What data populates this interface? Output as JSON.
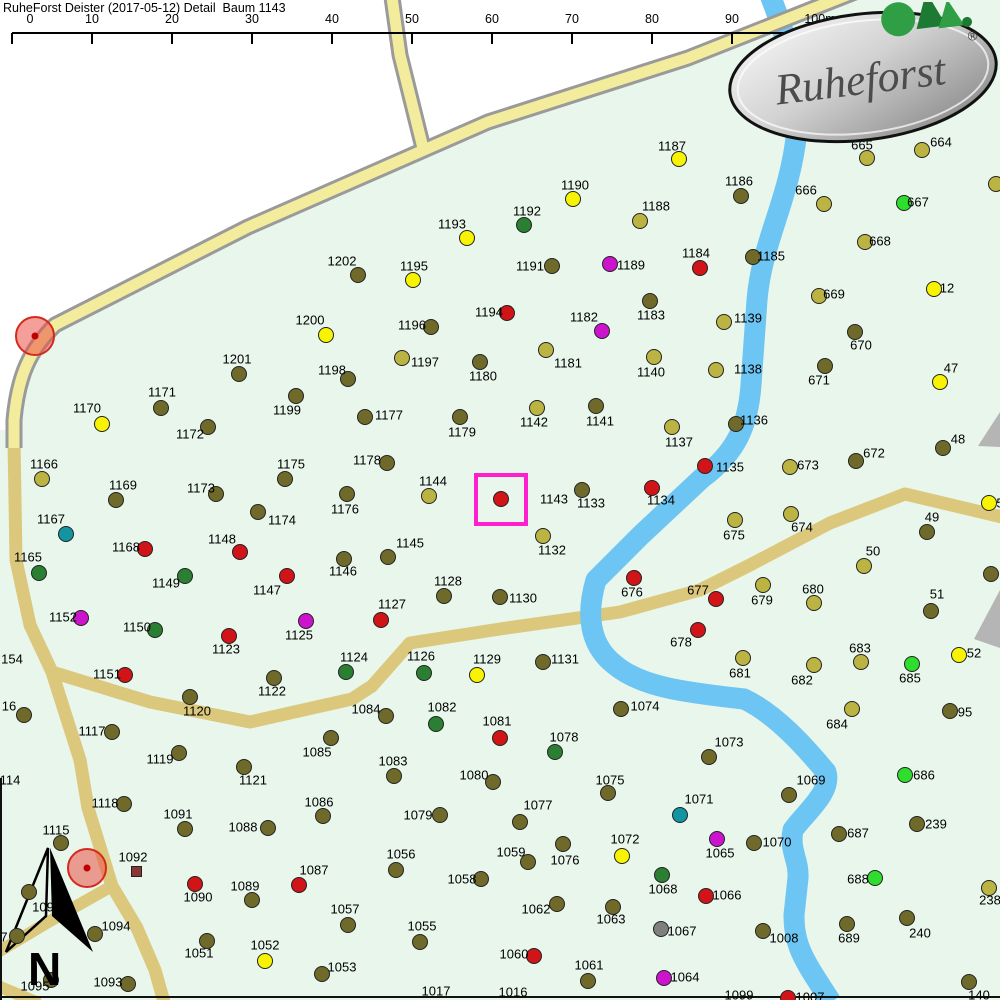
{
  "title": "RuheForst Deister (2017-05-12) Detail  Baum 1143",
  "scale_bar": {
    "y": 33,
    "x0": 12,
    "spacing": 80,
    "labels": [
      "0",
      "10",
      "20",
      "30",
      "40",
      "50",
      "60",
      "70",
      "80",
      "90",
      "100m"
    ]
  },
  "logo": {
    "text": "Ruheforst",
    "registered": "®"
  },
  "north_label": "N",
  "colors": {
    "o": "#6f6a2a",
    "k": "#bcb442",
    "y": "#f7f303",
    "g": "#2fdd2f",
    "dg": "#2b7f33",
    "r": "#d01418",
    "m": "#cc14cc",
    "t": "#1295a0",
    "gy": "#7f7f7f",
    "sq": "#8b3535"
  },
  "highlight": {
    "tree": "1143",
    "x": 474,
    "y": 473,
    "w": 54,
    "h": 53,
    "color": "#ff1fce"
  },
  "poi": [
    {
      "x": 35,
      "y": 336
    },
    {
      "x": 87,
      "y": 868
    }
  ],
  "trees": [
    {
      "n": "1187",
      "x": 679,
      "y": 159,
      "lx": 672,
      "ly": 146,
      "c": "y"
    },
    {
      "n": "1190",
      "x": 573,
      "y": 199,
      "lx": 575,
      "ly": 185,
      "c": "y"
    },
    {
      "n": "1192",
      "x": 524,
      "y": 225,
      "lx": 527,
      "ly": 211,
      "c": "dg"
    },
    {
      "n": "1188",
      "x": 640,
      "y": 221,
      "lx": 656,
      "ly": 206,
      "c": "k"
    },
    {
      "n": "1186",
      "x": 741,
      "y": 196,
      "lx": 739,
      "ly": 181,
      "c": "o"
    },
    {
      "n": "1193",
      "x": 467,
      "y": 238,
      "lx": 452,
      "ly": 224,
      "c": "y"
    },
    {
      "n": "1202",
      "x": 358,
      "y": 275,
      "lx": 342,
      "ly": 261,
      "c": "o"
    },
    {
      "n": "1195",
      "x": 413,
      "y": 280,
      "lx": 414,
      "ly": 266,
      "c": "y"
    },
    {
      "n": "1191",
      "x": 552,
      "y": 266,
      "lx": 530,
      "ly": 266,
      "c": "o"
    },
    {
      "n": "1189",
      "x": 610,
      "y": 264,
      "lx": 631,
      "ly": 265,
      "c": "m"
    },
    {
      "n": "1184",
      "x": 700,
      "y": 268,
      "lx": 696,
      "ly": 253,
      "c": "r"
    },
    {
      "n": "1185",
      "x": 753,
      "y": 257,
      "lx": 771,
      "ly": 256,
      "c": "o"
    },
    {
      "n": "1183",
      "x": 650,
      "y": 301,
      "lx": 651,
      "ly": 315,
      "c": "o"
    },
    {
      "n": "1194",
      "x": 507,
      "y": 313,
      "lx": 489,
      "ly": 312,
      "c": "r"
    },
    {
      "n": "1182",
      "x": 602,
      "y": 331,
      "lx": 584,
      "ly": 317,
      "c": "m"
    },
    {
      "n": "1181",
      "x": 546,
      "y": 350,
      "lx": 568,
      "ly": 363,
      "c": "k"
    },
    {
      "n": "1140",
      "x": 654,
      "y": 357,
      "lx": 651,
      "ly": 372,
      "c": "k"
    },
    {
      "n": "1139",
      "x": 724,
      "y": 322,
      "lx": 748,
      "ly": 318,
      "c": "k"
    },
    {
      "n": "1138",
      "x": 716,
      "y": 370,
      "lx": 748,
      "ly": 369,
      "c": "k"
    },
    {
      "n": "1136",
      "x": 736,
      "y": 424,
      "lx": 754,
      "ly": 420,
      "c": "o"
    },
    {
      "n": "1137",
      "x": 672,
      "y": 427,
      "lx": 679,
      "ly": 442,
      "c": "k"
    },
    {
      "n": "1135",
      "x": 705,
      "y": 466,
      "lx": 730,
      "ly": 467,
      "c": "r"
    },
    {
      "n": "1134",
      "x": 652,
      "y": 488,
      "lx": 661,
      "ly": 500,
      "c": "r"
    },
    {
      "n": "1133",
      "x": 582,
      "y": 490,
      "lx": 591,
      "ly": 503,
      "c": "o"
    },
    {
      "n": "1132",
      "x": 543,
      "y": 536,
      "lx": 552,
      "ly": 550,
      "c": "k"
    },
    {
      "n": "1143",
      "x": 501,
      "y": 499,
      "lx": 554,
      "ly": 499,
      "c": "r"
    },
    {
      "n": "1144",
      "x": 429,
      "y": 496,
      "lx": 433,
      "ly": 481,
      "c": "k"
    },
    {
      "n": "1145",
      "x": 388,
      "y": 557,
      "lx": 410,
      "ly": 543,
      "c": "o"
    },
    {
      "n": "1142",
      "x": 537,
      "y": 408,
      "lx": 534,
      "ly": 422,
      "c": "k"
    },
    {
      "n": "1141",
      "x": 596,
      "y": 406,
      "lx": 600,
      "ly": 421,
      "c": "o"
    },
    {
      "n": "1179",
      "x": 460,
      "y": 417,
      "lx": 462,
      "ly": 432,
      "c": "o"
    },
    {
      "n": "1180",
      "x": 480,
      "y": 362,
      "lx": 483,
      "ly": 376,
      "c": "o"
    },
    {
      "n": "1196",
      "x": 431,
      "y": 327,
      "lx": 412,
      "ly": 325,
      "c": "o"
    },
    {
      "n": "1197",
      "x": 402,
      "y": 358,
      "lx": 425,
      "ly": 362,
      "c": "k"
    },
    {
      "n": "1198",
      "x": 348,
      "y": 379,
      "lx": 332,
      "ly": 370,
      "c": "o"
    },
    {
      "n": "1200",
      "x": 326,
      "y": 335,
      "lx": 310,
      "ly": 320,
      "c": "y"
    },
    {
      "n": "1201",
      "x": 239,
      "y": 374,
      "lx": 237,
      "ly": 359,
      "c": "o"
    },
    {
      "n": "1199",
      "x": 296,
      "y": 396,
      "lx": 287,
      "ly": 410,
      "c": "o"
    },
    {
      "n": "1177",
      "x": 365,
      "y": 417,
      "lx": 389,
      "ly": 415,
      "c": "o"
    },
    {
      "n": "1178",
      "x": 387,
      "y": 463,
      "lx": 367,
      "ly": 460,
      "c": "o"
    },
    {
      "n": "1175",
      "x": 285,
      "y": 479,
      "lx": 291,
      "ly": 464,
      "c": "o"
    },
    {
      "n": "1176",
      "x": 347,
      "y": 494,
      "lx": 345,
      "ly": 509,
      "c": "o"
    },
    {
      "n": "1174",
      "x": 258,
      "y": 512,
      "lx": 282,
      "ly": 520,
      "c": "o"
    },
    {
      "n": "1171",
      "x": 161,
      "y": 408,
      "lx": 162,
      "ly": 392,
      "c": "o"
    },
    {
      "n": "1170",
      "x": 102,
      "y": 424,
      "lx": 87,
      "ly": 408,
      "c": "y"
    },
    {
      "n": "1172",
      "x": 208,
      "y": 427,
      "lx": 190,
      "ly": 434,
      "c": "o"
    },
    {
      "n": "1166",
      "x": 42,
      "y": 479,
      "lx": 44,
      "ly": 464,
      "c": "k"
    },
    {
      "n": "1169",
      "x": 116,
      "y": 500,
      "lx": 123,
      "ly": 485,
      "c": "o"
    },
    {
      "n": "1173",
      "x": 216,
      "y": 494,
      "lx": 201,
      "ly": 488,
      "c": "o"
    },
    {
      "n": "1167",
      "x": 66,
      "y": 534,
      "lx": 51,
      "ly": 519,
      "c": "t"
    },
    {
      "n": "1168",
      "x": 145,
      "y": 549,
      "lx": 126,
      "ly": 547,
      "c": "r"
    },
    {
      "n": "1148",
      "x": 240,
      "y": 552,
      "lx": 222,
      "ly": 539,
      "c": "r"
    },
    {
      "n": "1165",
      "x": 39,
      "y": 573,
      "lx": 28,
      "ly": 557,
      "c": "dg"
    },
    {
      "n": "1149",
      "x": 185,
      "y": 576,
      "lx": 166,
      "ly": 583,
      "c": "dg"
    },
    {
      "n": "1152",
      "x": 81,
      "y": 618,
      "lx": 63,
      "ly": 617,
      "c": "m"
    },
    {
      "n": "1150",
      "x": 155,
      "y": 630,
      "lx": 137,
      "ly": 627,
      "c": "dg"
    },
    {
      "n": "1123",
      "x": 229,
      "y": 636,
      "lx": 226,
      "ly": 649,
      "c": "r"
    },
    {
      "n": "1151",
      "x": 125,
      "y": 675,
      "lx": 107,
      "ly": 674,
      "c": "r"
    },
    {
      "n": "1120",
      "x": 190,
      "y": 697,
      "lx": 197,
      "ly": 711,
      "c": "o"
    },
    {
      "n": "1117",
      "x": 112,
      "y": 732,
      "lx": 92,
      "ly": 731,
      "c": "o"
    },
    {
      "n": "1119",
      "x": 179,
      "y": 753,
      "lx": 160,
      "ly": 759,
      "c": "o"
    },
    {
      "n": "1118",
      "x": 124,
      "y": 804,
      "lx": 105,
      "ly": 803,
      "c": "o"
    },
    {
      "n": "1121",
      "x": 244,
      "y": 767,
      "lx": 253,
      "ly": 780,
      "c": "o"
    },
    {
      "n": "1147",
      "x": 287,
      "y": 576,
      "lx": 267,
      "ly": 590,
      "c": "r"
    },
    {
      "n": "1146",
      "x": 344,
      "y": 559,
      "lx": 343,
      "ly": 571,
      "c": "o"
    },
    {
      "n": "1128",
      "x": 444,
      "y": 596,
      "lx": 448,
      "ly": 581,
      "c": "o"
    },
    {
      "n": "1127",
      "x": 381,
      "y": 620,
      "lx": 392,
      "ly": 604,
      "c": "r"
    },
    {
      "n": "1125",
      "x": 306,
      "y": 621,
      "lx": 299,
      "ly": 635,
      "c": "m"
    },
    {
      "n": "1124",
      "x": 346,
      "y": 672,
      "lx": 354,
      "ly": 657,
      "c": "dg"
    },
    {
      "n": "1126",
      "x": 424,
      "y": 673,
      "lx": 421,
      "ly": 656,
      "c": "dg"
    },
    {
      "n": "1129",
      "x": 477,
      "y": 675,
      "lx": 487,
      "ly": 659,
      "c": "y"
    },
    {
      "n": "1122",
      "x": 274,
      "y": 678,
      "lx": 272,
      "ly": 691,
      "c": "o"
    },
    {
      "n": "1130",
      "x": 500,
      "y": 597,
      "lx": 523,
      "ly": 598,
      "c": "o"
    },
    {
      "n": "1131",
      "x": 543,
      "y": 662,
      "lx": 565,
      "ly": 659,
      "c": "o"
    },
    {
      "n": "1084",
      "x": 386,
      "y": 716,
      "lx": 366,
      "ly": 709,
      "c": "o"
    },
    {
      "n": "1082",
      "x": 436,
      "y": 724,
      "lx": 442,
      "ly": 707,
      "c": "dg"
    },
    {
      "n": "1081",
      "x": 500,
      "y": 738,
      "lx": 497,
      "ly": 721,
      "c": "r"
    },
    {
      "n": "1085",
      "x": 331,
      "y": 738,
      "lx": 317,
      "ly": 752,
      "c": "o"
    },
    {
      "n": "1083",
      "x": 394,
      "y": 776,
      "lx": 393,
      "ly": 761,
      "c": "o"
    },
    {
      "n": "1080",
      "x": 493,
      "y": 782,
      "lx": 474,
      "ly": 775,
      "c": "o"
    },
    {
      "n": "1086",
      "x": 323,
      "y": 816,
      "lx": 319,
      "ly": 802,
      "c": "o"
    },
    {
      "n": "1074",
      "x": 621,
      "y": 709,
      "lx": 645,
      "ly": 706,
      "c": "o"
    },
    {
      "n": "1078",
      "x": 555,
      "y": 752,
      "lx": 564,
      "ly": 737,
      "c": "dg"
    },
    {
      "n": "1073",
      "x": 709,
      "y": 757,
      "lx": 729,
      "ly": 742,
      "c": "o"
    },
    {
      "n": "1075",
      "x": 608,
      "y": 793,
      "lx": 610,
      "ly": 780,
      "c": "o"
    },
    {
      "n": "1077",
      "x": 520,
      "y": 822,
      "lx": 538,
      "ly": 805,
      "c": "o"
    },
    {
      "n": "1071",
      "x": 680,
      "y": 815,
      "lx": 699,
      "ly": 799,
      "c": "t"
    },
    {
      "n": "676",
      "x": 634,
      "y": 578,
      "lx": 632,
      "ly": 592,
      "c": "r"
    },
    {
      "n": "677",
      "x": 716,
      "y": 599,
      "lx": 698,
      "ly": 590,
      "c": "r"
    },
    {
      "n": "678",
      "x": 698,
      "y": 630,
      "lx": 681,
      "ly": 642,
      "c": "r"
    },
    {
      "n": "675",
      "x": 735,
      "y": 520,
      "lx": 734,
      "ly": 535,
      "c": "k"
    },
    {
      "n": "681",
      "x": 743,
      "y": 658,
      "lx": 740,
      "ly": 673,
      "c": "k"
    },
    {
      "n": "673",
      "x": 790,
      "y": 467,
      "lx": 808,
      "ly": 465,
      "c": "k"
    },
    {
      "n": "672",
      "x": 856,
      "y": 461,
      "lx": 874,
      "ly": 453,
      "c": "o"
    },
    {
      "n": "48",
      "x": 943,
      "y": 448,
      "lx": 958,
      "ly": 439,
      "c": "o"
    },
    {
      "n": "674",
      "x": 791,
      "y": 514,
      "lx": 802,
      "ly": 527,
      "c": "k"
    },
    {
      "n": "49",
      "x": 927,
      "y": 532,
      "lx": 932,
      "ly": 517,
      "c": "o"
    },
    {
      "n": "50",
      "x": 864,
      "y": 566,
      "lx": 873,
      "ly": 551,
      "c": "k"
    },
    {
      "n": "679",
      "x": 763,
      "y": 585,
      "lx": 762,
      "ly": 600,
      "c": "k"
    },
    {
      "n": "680",
      "x": 814,
      "y": 603,
      "lx": 813,
      "ly": 589,
      "c": "k"
    },
    {
      "n": "51",
      "x": 931,
      "y": 611,
      "lx": 937,
      "ly": 594,
      "c": "o"
    },
    {
      "n": "52",
      "x": 959,
      "y": 655,
      "lx": 974,
      "ly": 653,
      "c": "y"
    },
    {
      "n": "683",
      "x": 861,
      "y": 662,
      "lx": 860,
      "ly": 648,
      "c": "k"
    },
    {
      "n": "682",
      "x": 814,
      "y": 665,
      "lx": 802,
      "ly": 680,
      "c": "k"
    },
    {
      "n": "685",
      "x": 912,
      "y": 664,
      "lx": 910,
      "ly": 678,
      "c": "g"
    },
    {
      "n": "684",
      "x": 852,
      "y": 709,
      "lx": 837,
      "ly": 724,
      "c": "k"
    },
    {
      "n": "95",
      "x": 950,
      "y": 711,
      "lx": 965,
      "ly": 712,
      "c": "o"
    },
    {
      "n": "686",
      "x": 905,
      "y": 775,
      "lx": 924,
      "ly": 775,
      "c": "g"
    },
    {
      "n": "239",
      "x": 917,
      "y": 824,
      "lx": 936,
      "ly": 824,
      "c": "o"
    },
    {
      "n": "687",
      "x": 839,
      "y": 834,
      "lx": 858,
      "ly": 833,
      "c": "o"
    },
    {
      "n": "1069",
      "x": 789,
      "y": 795,
      "lx": 811,
      "ly": 780,
      "c": "o"
    },
    {
      "n": "1070",
      "x": 754,
      "y": 843,
      "lx": 777,
      "ly": 842,
      "c": "o"
    },
    {
      "n": "688",
      "x": 875,
      "y": 878,
      "lx": 858,
      "ly": 879,
      "c": "g"
    },
    {
      "n": "238",
      "x": 989,
      "y": 888,
      "lx": 990,
      "ly": 900,
      "c": "k"
    },
    {
      "n": "1008",
      "x": 763,
      "y": 931,
      "lx": 784,
      "ly": 938,
      "c": "o"
    },
    {
      "n": "689",
      "x": 847,
      "y": 924,
      "lx": 849,
      "ly": 938,
      "c": "o"
    },
    {
      "n": "240",
      "x": 907,
      "y": 918,
      "lx": 920,
      "ly": 933,
      "c": "o"
    },
    {
      "n": "140",
      "x": 969,
      "y": 982,
      "lx": 979,
      "ly": 995,
      "c": "o"
    },
    {
      "n": "1007",
      "x": 788,
      "y": 998,
      "lx": 810,
      "ly": 997,
      "c": "r"
    },
    {
      "n": "666",
      "x": 824,
      "y": 204,
      "lx": 806,
      "ly": 190,
      "c": "k"
    },
    {
      "n": "667",
      "x": 904,
      "y": 203,
      "lx": 918,
      "ly": 202,
      "c": "g"
    },
    {
      "n": "668",
      "x": 865,
      "y": 242,
      "lx": 880,
      "ly": 241,
      "c": "k"
    },
    {
      "n": "665",
      "x": 867,
      "y": 158,
      "lx": 862,
      "ly": 145,
      "c": "k"
    },
    {
      "n": "664",
      "x": 922,
      "y": 150,
      "lx": 941,
      "ly": 142,
      "c": "k"
    },
    {
      "n": "12",
      "x": 934,
      "y": 289,
      "lx": 947,
      "ly": 288,
      "c": "y"
    },
    {
      "n": "669",
      "x": 819,
      "y": 296,
      "lx": 834,
      "ly": 294,
      "c": "k"
    },
    {
      "n": "670",
      "x": 855,
      "y": 332,
      "lx": 861,
      "ly": 345,
      "c": "o"
    },
    {
      "n": "671",
      "x": 825,
      "y": 366,
      "lx": 819,
      "ly": 380,
      "c": "o"
    },
    {
      "n": "47",
      "x": 940,
      "y": 382,
      "lx": 951,
      "ly": 368,
      "c": "y"
    },
    {
      "n": "1091",
      "x": 185,
      "y": 829,
      "lx": 178,
      "ly": 814,
      "c": "o"
    },
    {
      "n": "1088",
      "x": 268,
      "y": 828,
      "lx": 243,
      "ly": 827,
      "c": "o"
    },
    {
      "n": "1115",
      "x": 61,
      "y": 843,
      "lx": 56,
      "ly": 830,
      "c": "o"
    },
    {
      "n": "1090",
      "x": 195,
      "y": 884,
      "lx": 198,
      "ly": 897,
      "c": "r"
    },
    {
      "n": "1089",
      "x": 252,
      "y": 900,
      "lx": 245,
      "ly": 886,
      "c": "o"
    },
    {
      "n": "1094",
      "x": 95,
      "y": 934,
      "lx": 116,
      "ly": 926,
      "c": "o"
    },
    {
      "n": "1095",
      "x": 51,
      "y": 980,
      "lx": 35,
      "ly": 986,
      "c": "o"
    },
    {
      "n": "1093",
      "x": 128,
      "y": 984,
      "lx": 108,
      "ly": 982,
      "c": "o"
    },
    {
      "n": "1051",
      "x": 207,
      "y": 941,
      "lx": 199,
      "ly": 953,
      "c": "o"
    },
    {
      "n": "1052",
      "x": 265,
      "y": 961,
      "lx": 265,
      "ly": 945,
      "c": "y"
    },
    {
      "n": "1053",
      "x": 322,
      "y": 974,
      "lx": 342,
      "ly": 967,
      "c": "o"
    },
    {
      "n": "1057",
      "x": 348,
      "y": 925,
      "lx": 345,
      "ly": 909,
      "c": "o"
    },
    {
      "n": "1055",
      "x": 420,
      "y": 942,
      "lx": 422,
      "ly": 926,
      "c": "o"
    },
    {
      "n": "1056",
      "x": 396,
      "y": 870,
      "lx": 401,
      "ly": 854,
      "c": "o"
    },
    {
      "n": "1058",
      "x": 481,
      "y": 879,
      "lx": 462,
      "ly": 879,
      "c": "o"
    },
    {
      "n": "1079",
      "x": 440,
      "y": 815,
      "lx": 418,
      "ly": 815,
      "c": "o"
    },
    {
      "n": "1087",
      "x": 299,
      "y": 885,
      "lx": 314,
      "ly": 870,
      "c": "r"
    },
    {
      "n": "1059",
      "x": 528,
      "y": 862,
      "lx": 511,
      "ly": 852,
      "c": "o"
    },
    {
      "n": "1076",
      "x": 563,
      "y": 844,
      "lx": 565,
      "ly": 860,
      "c": "o"
    },
    {
      "n": "1072",
      "x": 622,
      "y": 856,
      "lx": 625,
      "ly": 839,
      "c": "y"
    },
    {
      "n": "1065",
      "x": 717,
      "y": 839,
      "lx": 720,
      "ly": 853,
      "c": "m"
    },
    {
      "n": "1068",
      "x": 662,
      "y": 875,
      "lx": 663,
      "ly": 889,
      "c": "dg"
    },
    {
      "n": "1066",
      "x": 706,
      "y": 896,
      "lx": 727,
      "ly": 895,
      "c": "r"
    },
    {
      "n": "1062",
      "x": 557,
      "y": 904,
      "lx": 536,
      "ly": 909,
      "c": "o"
    },
    {
      "n": "1063",
      "x": 613,
      "y": 907,
      "lx": 611,
      "ly": 919,
      "c": "o"
    },
    {
      "n": "1067",
      "x": 661,
      "y": 929,
      "lx": 682,
      "ly": 931,
      "c": "gy"
    },
    {
      "n": "1060",
      "x": 534,
      "y": 956,
      "lx": 514,
      "ly": 954,
      "c": "r"
    },
    {
      "n": "1061",
      "x": 588,
      "y": 981,
      "lx": 589,
      "ly": 965,
      "c": "o"
    },
    {
      "n": "1064",
      "x": 664,
      "y": 978,
      "lx": 685,
      "ly": 977,
      "c": "m"
    },
    {
      "n": "1092",
      "x": 136,
      "y": 871,
      "lx": 133,
      "ly": 857,
      "c": "sq",
      "shape": "square"
    },
    {
      "n": "1017",
      "lx": 436,
      "ly": 991
    },
    {
      "n": "1016",
      "lx": 513,
      "ly": 992
    },
    {
      "n": "1099",
      "lx": 739,
      "ly": 995
    },
    {
      "n": "154",
      "lx": 12,
      "ly": 659
    },
    {
      "n": "114",
      "lx": 10,
      "ly": 780
    },
    {
      "n": "16",
      "x": 24,
      "y": 715,
      "lx": 9,
      "ly": 706,
      "c": "o"
    },
    {
      "n": "7",
      "x": 17,
      "y": 936,
      "lx": 4,
      "ly": 937,
      "c": "o"
    },
    {
      "n": "109",
      "x": 29,
      "y": 892,
      "lx": 43,
      "ly": 907,
      "c": "o"
    },
    {
      "n": "5",
      "x": 989,
      "y": 503,
      "lx": 1000,
      "ly": 503,
      "c": "y"
    },
    {
      "n": "",
      "x": 996,
      "y": 184,
      "c": "k"
    },
    {
      "n": "",
      "x": 991,
      "y": 574,
      "c": "o"
    }
  ]
}
